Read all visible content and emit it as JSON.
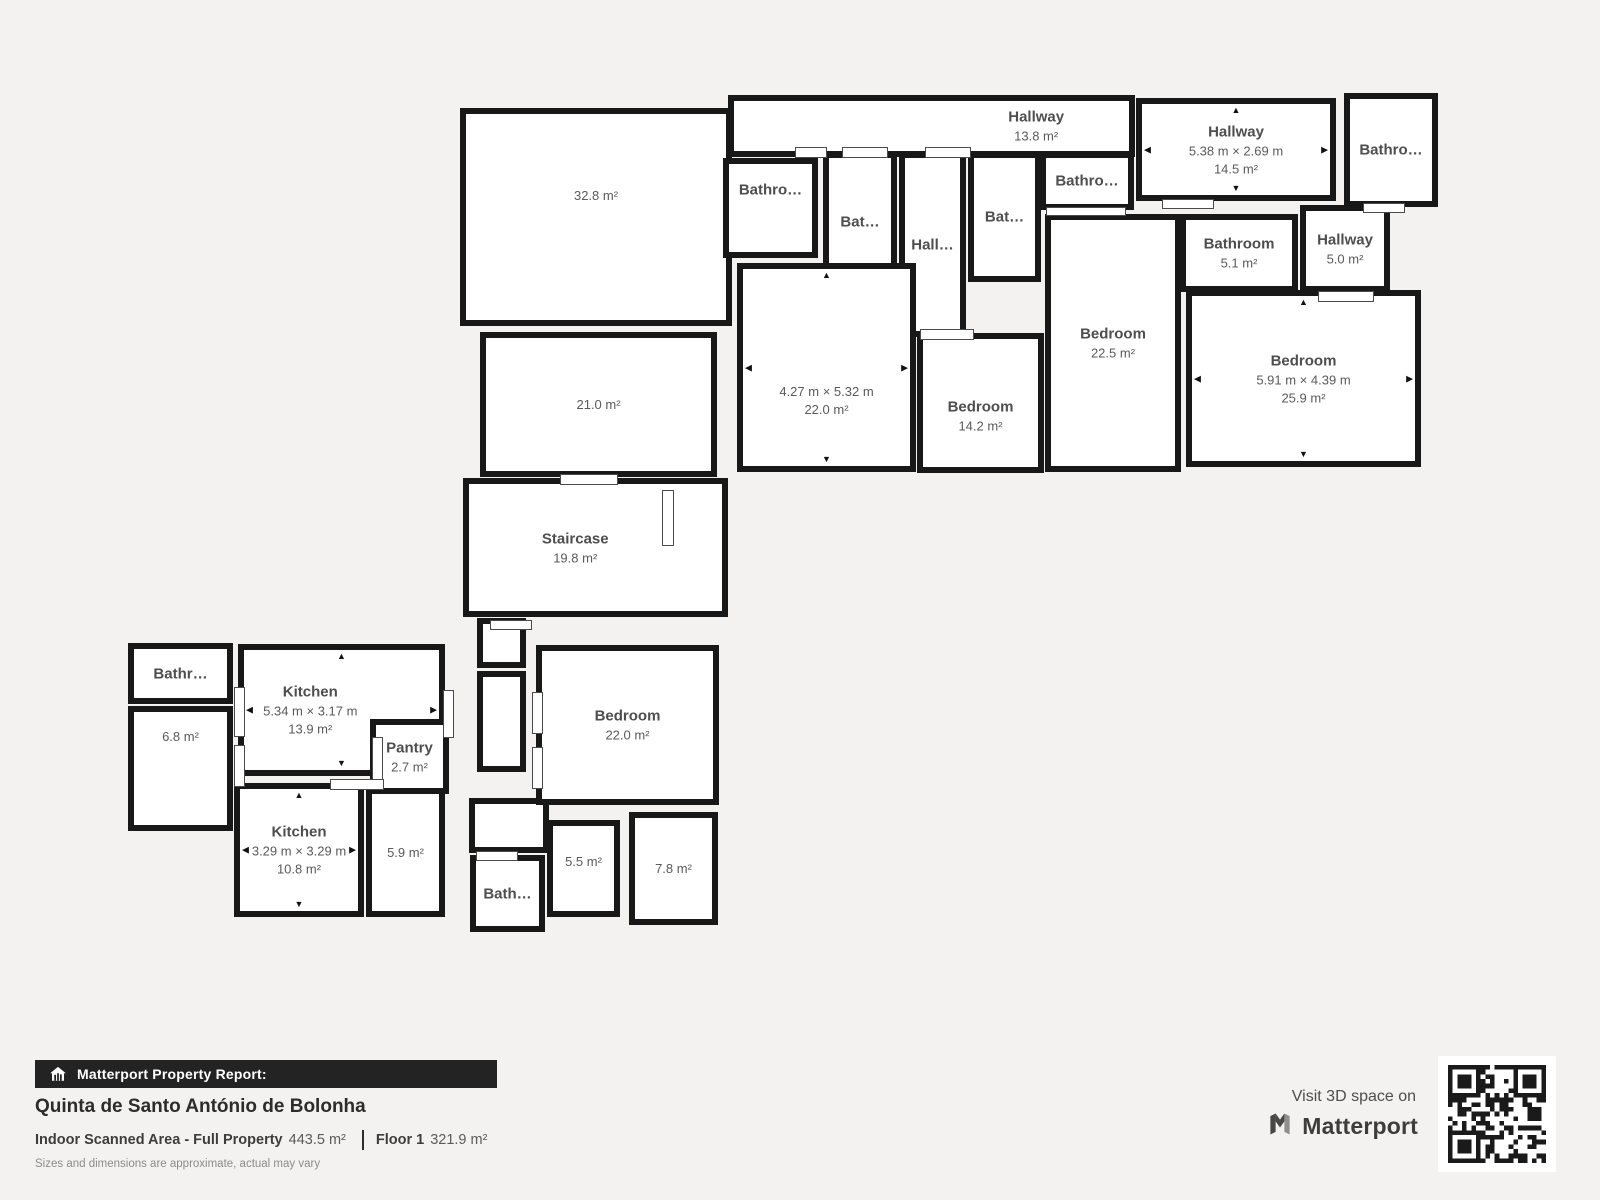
{
  "colors": {
    "background": "#f4f2f0",
    "wall": "#181818",
    "room_fill": "#ffffff",
    "label_text": "#565656",
    "banner_bg": "#232323",
    "banner_text": "#ffffff"
  },
  "icons": {
    "arrow_up": "▲",
    "arrow_down": "▼",
    "arrow_left": "◀",
    "arrow_right": "▶"
  },
  "rooms": {
    "area_328": {
      "area": "32.8 m²"
    },
    "hallway_138": {
      "name": "Hallway",
      "area": "13.8 m²"
    },
    "bathro_t1": {
      "name": "Bathro…"
    },
    "bat_t2": {
      "name": "Bat…"
    },
    "hall_t3": {
      "name": "Hall…"
    },
    "bat_t4": {
      "name": "Bat…"
    },
    "bathro_t5": {
      "name": "Bathro…"
    },
    "hallway_145": {
      "name": "Hallway",
      "dims": "5.38 m × 2.69 m",
      "area": "14.5 m²"
    },
    "bathro_tr": {
      "name": "Bathro…"
    },
    "bathroom_51": {
      "name": "Bathroom",
      "area": "5.1 m²"
    },
    "hallway_50": {
      "name": "Hallway",
      "area": "5.0 m²"
    },
    "room_220a": {
      "dims": "4.27 m × 5.32 m",
      "area": "22.0 m²"
    },
    "bedroom_142": {
      "name": "Bedroom",
      "area": "14.2 m²"
    },
    "bedroom_225": {
      "name": "Bedroom",
      "area": "22.5 m²"
    },
    "bedroom_259": {
      "name": "Bedroom",
      "dims": "5.91 m × 4.39 m",
      "area": "25.9 m²"
    },
    "area_210": {
      "area": "21.0 m²"
    },
    "staircase": {
      "name": "Staircase",
      "area": "19.8 m²"
    },
    "bathr_bl": {
      "name": "Bathr…"
    },
    "area_68": {
      "area": "6.8 m²"
    },
    "kitchen_139": {
      "name": "Kitchen",
      "dims": "5.34 m × 3.17 m",
      "area": "13.9 m²"
    },
    "kitchen_108": {
      "name": "Kitchen",
      "dims": "3.29 m × 3.29 m",
      "area": "10.8 m²"
    },
    "area_59": {
      "area": "5.9 m²"
    },
    "pantry": {
      "name": "Pantry",
      "area": "2.7 m²"
    },
    "bathroom_bc": {
      "name": "Bath…"
    },
    "area_55": {
      "area": "5.5 m²"
    },
    "area_78": {
      "area": "7.8 m²"
    },
    "bedroom_220b": {
      "name": "Bedroom",
      "area": "22.0 m²"
    }
  },
  "footer": {
    "report_label": "Matterport Property Report:",
    "property_name": "Quinta de Santo António de Bolonha",
    "scanned_area_label": "Indoor Scanned Area - Full Property",
    "scanned_area_value": "443.5 m²",
    "floor_label": "Floor 1",
    "floor_value": "321.9 m²",
    "disclaimer": "Sizes and dimensions are approximate, actual may vary"
  },
  "cta": {
    "visit_text": "Visit 3D space on",
    "brand": "Matterport"
  }
}
